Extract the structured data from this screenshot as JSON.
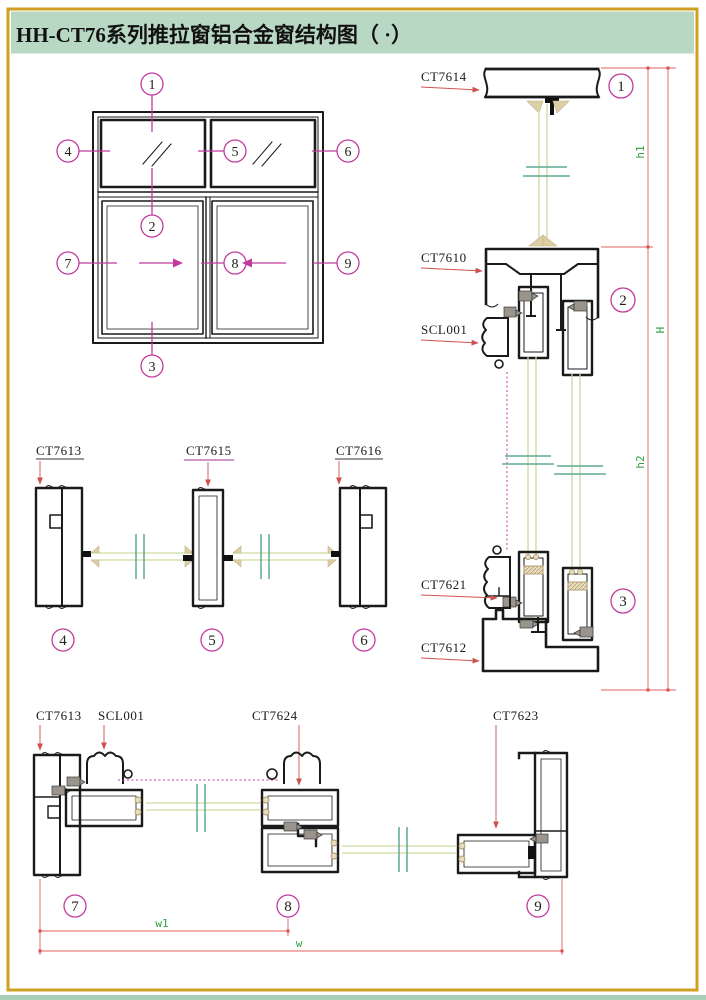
{
  "title": "HH-CT76系列推拉窗铝合金窗结构图（ ·）",
  "callouts": [
    "1",
    "2",
    "3",
    "4",
    "5",
    "6",
    "7",
    "8",
    "9"
  ],
  "vertical_section": {
    "labels": {
      "head": "CT7614",
      "transom": "CT7610",
      "lock": "SCL001",
      "sash_bottom": "CT7621",
      "sill": "CT7612"
    },
    "dims": {
      "h1": "h1",
      "H": "H",
      "h2": "h2"
    }
  },
  "mid_section": {
    "labels": {
      "left_jamb": "CT7613",
      "mullion": "CT7615",
      "right_jamb": "CT7616"
    }
  },
  "bottom_section": {
    "labels": {
      "left_jamb": "CT7613",
      "lock": "SCL001",
      "interlock": "CT7624",
      "latch": "CT7623"
    },
    "dims": {
      "w1": "w1",
      "w": "w"
    }
  },
  "colors": {
    "page_border": "#d0a020",
    "header_bg": "#b9d8c3",
    "callout_magenta": "#c23a9e",
    "dimension_red": "#e06060",
    "dim_label_green": "#2e9e3e",
    "glass_green": "#ccdc9e",
    "glass_break_teal": "#5fa896",
    "profile_black": "#1a1a1a",
    "gasket_gray": "#9a948c",
    "setting_block_tan": "#ddcfa5"
  }
}
